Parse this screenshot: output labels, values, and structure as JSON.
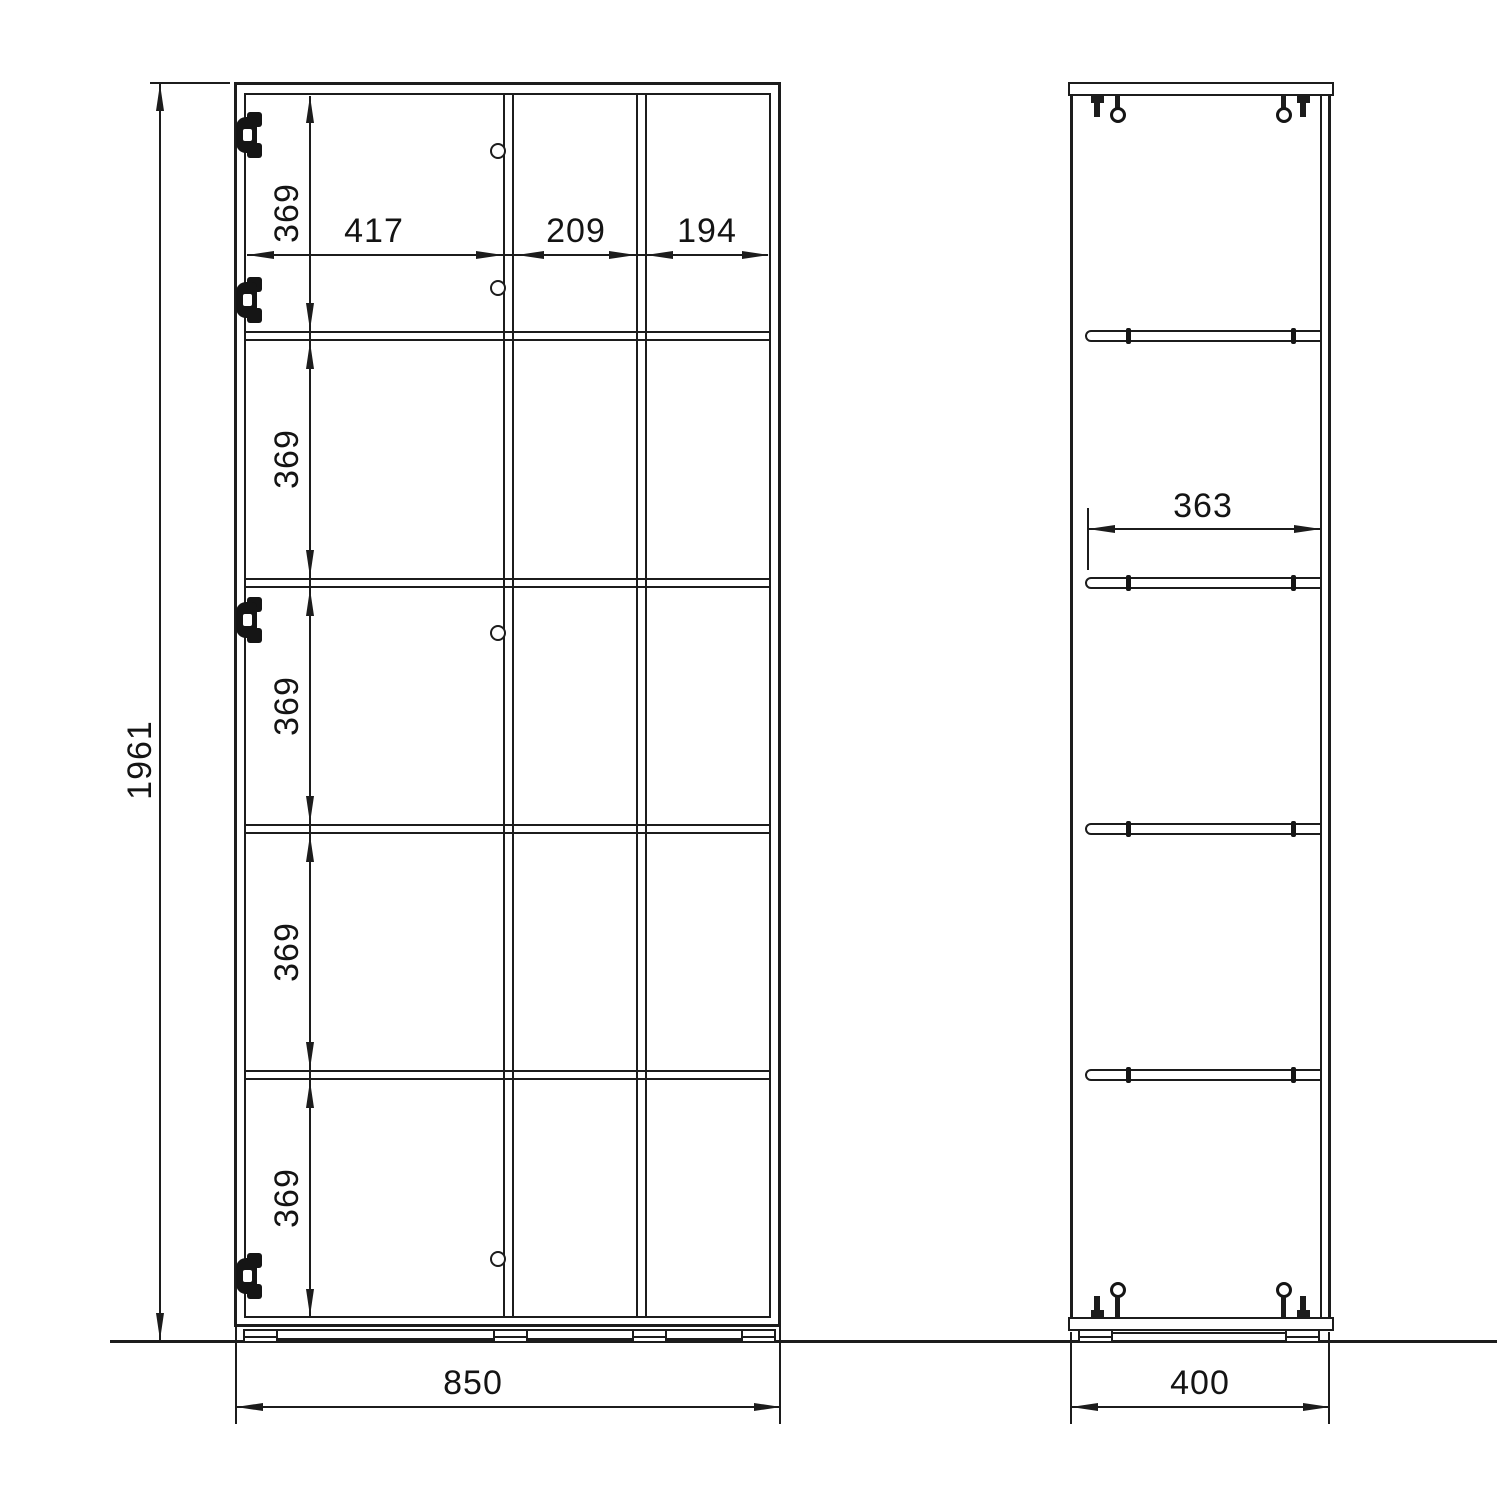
{
  "title": "cabinet-technical-drawing",
  "front_view": {
    "overall_height_mm": "1961",
    "overall_width_mm": "850",
    "compartment_widths_mm": [
      "417",
      "209",
      "194"
    ],
    "row_heights_mm": [
      "369",
      "369",
      "369",
      "369",
      "369"
    ]
  },
  "side_view": {
    "overall_depth_mm": "400",
    "shelf_depth_mm": "363"
  },
  "style": {
    "line_color": "#1c1c1c",
    "background": "#ffffff"
  }
}
